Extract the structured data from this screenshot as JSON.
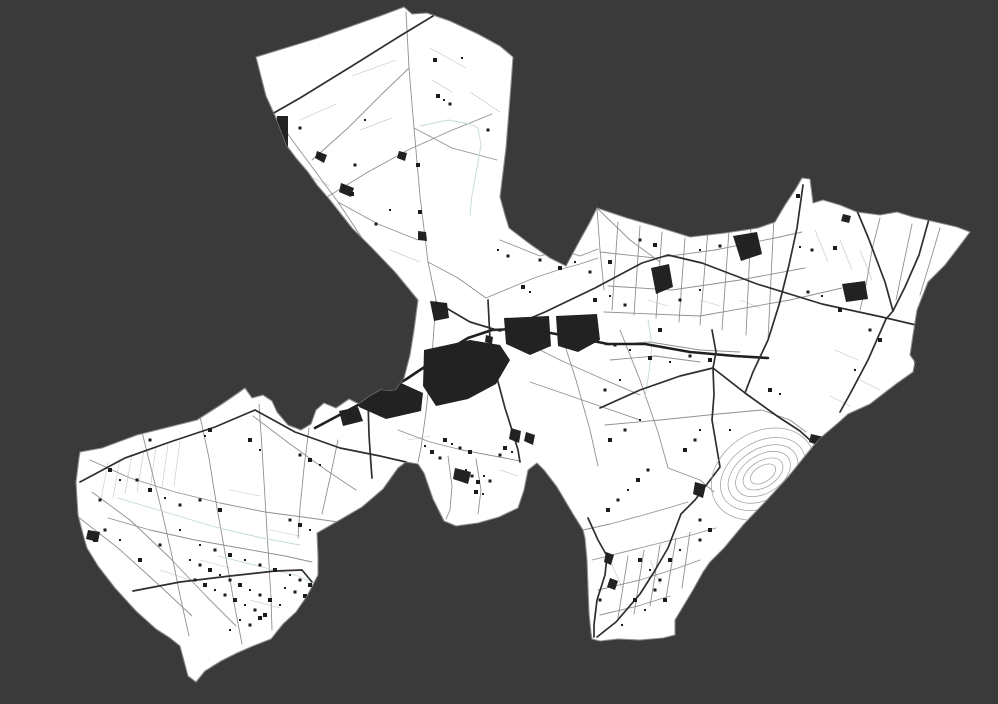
{
  "canvas": {
    "width": 998,
    "height": 704,
    "background": "#3a3a3a"
  },
  "map": {
    "region": {
      "fill": "#ffffff",
      "stroke": "#8d8d8d",
      "stroke_width": 1.1,
      "boundary": "M256,57 L318,38 L380,16 L404,7 L412,14 L427,13 L450,21 L478,34 L500,46 L513,57 L511,85 L506,148 L500,197 L505,215 L509,228 L530,244 L550,258 L566,266 L580,240 L590,222 L597,208 L627,218 L655,226 L690,237 L725,233 L758,228 L775,222 L785,205 L795,190 L802,178 L810,179 L813,203 L823,200 L840,205 L857,212 L880,215 L897,212 L913,217 L927,220 L940,223 L957,227 L970,232 L958,248 L945,265 L928,282 L917,310 L913,335 L910,355 L915,362 L913,372 L896,384 L870,404 L848,414 L838,423 L818,440 L805,456 L788,477 L766,501 L744,524 L724,548 L710,562 L703,572 L693,590 L675,620 L675,635 L663,638 L640,640 L618,639 L600,641 L592,639 L591,633 L589,613 L588,587 L587,560 L585,538 L583,530 L573,514 L557,487 L544,470 L537,463 L528,470 L524,490 L518,508 L499,517 L478,523 L456,526 L444,521 L433,499 L424,473 L418,464 L406,462 L398,468 L383,489 L362,507 L338,521 L317,533 L318,556 L318,575 L307,596 L296,612 L283,624 L271,639 L253,646 L237,653 L221,661 L205,671 L196,682 L188,676 L184,661 L180,646 L170,638 L156,629 L136,611 L115,588 L98,566 L87,548 L84,538 L78,515 L76,482 L79,458 L80,452 L102,448 L137,435 L165,428 L197,420 L222,404 L238,393 L245,388 L252,398 L263,395 L272,401 L277,412 L288,425 L301,430 L311,424 L316,410 L324,403 L336,408 L349,399 L359,404 L370,396 L381,390 L389,391 L396,390 L404,378 L410,355 L414,330 L418,300 L395,272 L372,248 L352,228 L330,200 L317,185 L308,172 L296,158 L287,146 L276,118 L266,96 Z"
    },
    "styles": {
      "road_major": {
        "color": "#2e2e2e",
        "width": 1.7
      },
      "road_medium": {
        "color": "#909090",
        "width": 0.9
      },
      "road_minor": {
        "color": "#c3c3c3",
        "width": 0.6
      },
      "waterway": {
        "color": "#c5dad6",
        "width": 0.9
      },
      "canal": {
        "color": "#1f1f1f",
        "width": 2.6
      },
      "water_fill": "#222222",
      "building_fill": "#1b1b1b",
      "quarry": {
        "color": "#9a9a9a",
        "width": 0.7
      }
    },
    "canal": "315,428 345,412 375,396 405,380 432,362 450,349 468,338 492,330 515,329 545,332 578,338 608,344 645,344 690,352 735,356 768,358",
    "roads_major": [
      "433,16 400,36 352,66 300,98 272,114",
      "436,302 470,322 500,331 545,312 595,288 642,263 668,255 702,263 757,284 822,304 882,317 916,325",
      "929,219 919,255 905,287 893,311 886,319",
      "850,194 868,237 885,282 893,311",
      "712,330 716,352 713,368 745,393 777,416 800,431 811,441",
      "600,408 640,390 680,376 713,368",
      "713,368 714,395 712,420 720,467 695,500 681,514 668,548 654,572 640,594 616,622 597,637",
      "80,482 125,458 170,442 215,427 255,410 295,432 340,448 380,456 406,462",
      "133,591 180,582 230,576 275,571 302,570 312,582",
      "367,367 368,400 369,435 371,465 372,478",
      "803,185 797,228 789,265 779,305 768,340 753,372 745,393",
      "588,518 598,540 607,556 605,575 597,600 594,625 594,637",
      "488,300 490,340 497,378 505,408 512,430 518,450 520,462",
      "886,319 868,360 850,394 840,412"
    ],
    "roads_medium": [
      "327,197 368,172 408,150 450,131 492,114",
      "265,102 298,148 338,202 374,256 396,294",
      "406,12 409,68 414,128 420,196 428,262 436,300",
      "409,68 382,94 348,128 312,160",
      "414,128 452,148 497,160",
      "338,202 378,224 418,240",
      "428,262 458,278 486,298",
      "486,298 510,288 534,278 558,270 580,264 598,258",
      "436,300 432,356 426,412 421,448 418,462",
      "398,430 430,442 462,450 494,456 520,461",
      "448,456 452,486 450,510 446,519",
      "476,459 481,490 478,514",
      "500,240 520,248 540,256 562,250 580,256 598,249",
      "90,460 130,478 175,492 220,503 265,512 310,518 338,522",
      "108,518 150,530 195,540 240,548 285,556 312,562",
      "142,432 152,472 162,512 172,556 181,600 189,636",
      "199,412 209,458 217,508 226,558 235,608 242,644",
      "259,404 262,448 265,498 268,548 271,598 272,630",
      "309,428 304,468 300,508 298,538",
      "92,492 130,520 170,558 208,598 236,626",
      "77,516 118,548 160,586 192,616",
      "338,440 330,478 322,514",
      "253,416 290,444 326,470 356,490",
      "618,222 612,310",
      "640,226 634,315",
      "662,232 656,318",
      "685,238 679,322",
      "708,230 700,325",
      "730,216 722,330",
      "752,204 746,335",
      "775,196 768,340",
      "600,252 655,258 715,250 775,238 802,232",
      "608,286 672,290 740,280 805,268",
      "604,312 700,316 790,300 842,288",
      "880,218 872,250 866,285 860,310",
      "912,224 904,262 896,300",
      "940,228 930,262 920,295",
      "605,345 650,342 700,350 740,352",
      "610,360 655,356 700,362",
      "560,330 576,380 590,430 598,466",
      "620,330 640,380 658,432 668,468",
      "520,340 560,360 605,380 640,395",
      "530,382 588,402 640,420",
      "605,425 660,420 718,414 762,410 790,420 806,432",
      "592,560 640,548 688,536 716,528",
      "598,590 640,580 678,568 700,560",
      "600,615 638,606 670,596",
      "583,530 610,524 640,516 668,508 688,502",
      "628,556 618,618",
      "644,550 634,614",
      "660,545 650,606",
      "676,538 666,598",
      "690,532 682,588",
      "597,208 600,250 604,290",
      "597,208 630,240 660,262",
      "668,468 700,480 714,492"
    ],
    "roads_minor": [
      "300,120 336,104",
      "352,76 396,60",
      "430,48 466,68",
      "470,92 500,112",
      "360,130 392,118",
      "310,230 350,250",
      "390,250 420,262",
      "432,80 452,92",
      "296,170 330,186",
      "108,462 101,500",
      "120,458 113,498",
      "132,454 125,494",
      "144,450 137,492",
      "156,447 150,490",
      "168,444 162,488",
      "180,441 174,486",
      "230,490 260,496",
      "270,530 300,536",
      "200,560 230,568",
      "250,600 280,608",
      "160,570 190,580",
      "840,240 852,270",
      "815,230 828,262",
      "860,250 872,280",
      "648,300 668,306",
      "700,300 720,306",
      "740,300 760,308",
      "835,350 858,360",
      "860,380 880,390",
      "830,396 850,406",
      "610,560 622,588",
      "650,560 660,584",
      "408,440 430,436",
      "500,470 518,476"
    ],
    "waterways": [
      "478,128 481,145 477,168 472,195 470,215",
      "420,126 448,120 470,124 478,128",
      "648,320 652,345 649,372 645,398",
      "218,556 258,566 298,576 311,582",
      "118,498 165,512 215,527 262,538 300,545"
    ],
    "lakes": [
      "M504,318 L549,316 L551,346 L530,355 L506,344 Z",
      "M556,316 L597,314 L600,340 L578,352 L558,346 Z",
      "M424,350 L470,340 L500,345 L510,360 L496,384 L468,399 L436,406 L423,386 Z",
      "M361,388 L401,383 L423,393 L421,411 L386,419 L359,407 Z",
      "M339,411 L358,407 L363,421 L343,426 Z",
      "M430,301 L447,303 L449,318 L434,321 Z",
      "M391,309 L404,311 L405,323 L392,324 Z",
      "M486,335 L493,337 L492,344 L485,342 Z",
      "M651,268 L669,264 L673,287 L656,294 Z",
      "M733,236 L757,232 L762,254 L741,261 Z",
      "M842,284 L865,281 L868,299 L846,302 Z",
      "M914,360 L931,358 L934,384 L917,386 Z",
      "M277,116 L288,116 L288,147 L277,147 Z",
      "M317,151 L327,155 L324,163 L315,158 Z",
      "M341,183 L354,188 L351,197 L339,192 Z",
      "M511,428 L521,431 L519,443 L509,439 Z",
      "M526,432 L535,435 L533,445 L524,441 Z",
      "M695,482 L706,485 L703,498 L693,494 Z",
      "M811,434 L824,437 L820,446 L809,442 Z",
      "M843,214 L851,216 L849,223 L841,221 Z",
      "M455,468 L471,472 L468,484 L453,479 Z",
      "M606,552 L614,555 L611,565 L604,562 Z",
      "M610,578 L618,581 L615,590 L607,587 Z",
      "M399,151 L407,153 L405,161 L397,158 Z",
      "M418,231 L426,232 L427,241 L418,240 Z",
      "M88,530 L100,532 L98,542 L86,539 Z"
    ],
    "quarry": {
      "cx": 763,
      "cy": 474,
      "rotation": -32,
      "rings": [
        [
          55,
          42
        ],
        [
          46,
          32
        ],
        [
          38,
          25
        ],
        [
          30,
          19
        ],
        [
          22,
          13
        ],
        [
          14,
          8
        ]
      ]
    },
    "buildings": [
      [
        320,
        156
      ],
      [
        344,
        187
      ],
      [
        352,
        194
      ],
      [
        360,
        251
      ],
      [
        376,
        224
      ],
      [
        438,
        96
      ],
      [
        444,
        100
      ],
      [
        450,
        104
      ],
      [
        420,
        212
      ],
      [
        365,
        120
      ],
      [
        300,
        128
      ],
      [
        435,
        60
      ],
      [
        462,
        58
      ],
      [
        488,
        130
      ],
      [
        418,
        165
      ],
      [
        390,
        210
      ],
      [
        355,
        165
      ],
      [
        523,
        287
      ],
      [
        530,
        292
      ],
      [
        540,
        260
      ],
      [
        560,
        268
      ],
      [
        575,
        262
      ],
      [
        590,
        272
      ],
      [
        610,
        262
      ],
      [
        498,
        250
      ],
      [
        508,
        256
      ],
      [
        595,
        300
      ],
      [
        610,
        296
      ],
      [
        625,
        305
      ],
      [
        445,
        440
      ],
      [
        452,
        444
      ],
      [
        460,
        448
      ],
      [
        470,
        452
      ],
      [
        466,
        470
      ],
      [
        472,
        476
      ],
      [
        478,
        482
      ],
      [
        484,
        476
      ],
      [
        490,
        481
      ],
      [
        476,
        492
      ],
      [
        483,
        494
      ],
      [
        440,
        458
      ],
      [
        432,
        452
      ],
      [
        425,
        446
      ],
      [
        500,
        455
      ],
      [
        505,
        448
      ],
      [
        512,
        452
      ],
      [
        640,
        240
      ],
      [
        655,
        245
      ],
      [
        700,
        250
      ],
      [
        720,
        246
      ],
      [
        798,
        196
      ],
      [
        800,
        247
      ],
      [
        812,
        250
      ],
      [
        835,
        248
      ],
      [
        822,
        296
      ],
      [
        808,
        292
      ],
      [
        840,
        310
      ],
      [
        700,
        290
      ],
      [
        680,
        300
      ],
      [
        660,
        330
      ],
      [
        630,
        350
      ],
      [
        615,
        345
      ],
      [
        650,
        358
      ],
      [
        670,
        362
      ],
      [
        690,
        356
      ],
      [
        710,
        360
      ],
      [
        640,
        420
      ],
      [
        625,
        430
      ],
      [
        610,
        440
      ],
      [
        700,
        430
      ],
      [
        695,
        440
      ],
      [
        685,
        450
      ],
      [
        730,
        430
      ],
      [
        648,
        470
      ],
      [
        638,
        480
      ],
      [
        628,
        490
      ],
      [
        618,
        500
      ],
      [
        608,
        510
      ],
      [
        620,
        380
      ],
      [
        605,
        390
      ],
      [
        770,
        390
      ],
      [
        780,
        394
      ],
      [
        870,
        330
      ],
      [
        880,
        340
      ],
      [
        855,
        370
      ],
      [
        600,
        600
      ],
      [
        640,
        560
      ],
      [
        650,
        570
      ],
      [
        660,
        580
      ],
      [
        670,
        560
      ],
      [
        680,
        550
      ],
      [
        700,
        540
      ],
      [
        635,
        600
      ],
      [
        645,
        610
      ],
      [
        655,
        590
      ],
      [
        665,
        600
      ],
      [
        622,
        625
      ],
      [
        700,
        520
      ],
      [
        710,
        530
      ],
      [
        190,
        560
      ],
      [
        200,
        565
      ],
      [
        210,
        570
      ],
      [
        220,
        575
      ],
      [
        230,
        580
      ],
      [
        240,
        585
      ],
      [
        250,
        590
      ],
      [
        260,
        595
      ],
      [
        270,
        600
      ],
      [
        280,
        605
      ],
      [
        195,
        580
      ],
      [
        205,
        585
      ],
      [
        215,
        590
      ],
      [
        225,
        595
      ],
      [
        235,
        600
      ],
      [
        245,
        605
      ],
      [
        255,
        610
      ],
      [
        265,
        615
      ],
      [
        200,
        545
      ],
      [
        215,
        550
      ],
      [
        230,
        555
      ],
      [
        245,
        560
      ],
      [
        260,
        565
      ],
      [
        275,
        570
      ],
      [
        290,
        575
      ],
      [
        300,
        580
      ],
      [
        310,
        585
      ],
      [
        285,
        588
      ],
      [
        295,
        592
      ],
      [
        305,
        596
      ],
      [
        240,
        620
      ],
      [
        250,
        625
      ],
      [
        260,
        618
      ],
      [
        230,
        630
      ],
      [
        137,
        480
      ],
      [
        150,
        490
      ],
      [
        165,
        498
      ],
      [
        180,
        505
      ],
      [
        110,
        470
      ],
      [
        120,
        480
      ],
      [
        100,
        500
      ],
      [
        210,
        430
      ],
      [
        205,
        436
      ],
      [
        150,
        440
      ],
      [
        250,
        440
      ],
      [
        260,
        450
      ],
      [
        300,
        455
      ],
      [
        310,
        460
      ],
      [
        320,
        465
      ],
      [
        290,
        520
      ],
      [
        300,
        525
      ],
      [
        310,
        530
      ],
      [
        320,
        535
      ],
      [
        330,
        540
      ],
      [
        340,
        545
      ],
      [
        200,
        500
      ],
      [
        220,
        510
      ],
      [
        180,
        530
      ],
      [
        160,
        545
      ],
      [
        140,
        560
      ],
      [
        120,
        540
      ],
      [
        105,
        530
      ],
      [
        95,
        540
      ]
    ]
  }
}
